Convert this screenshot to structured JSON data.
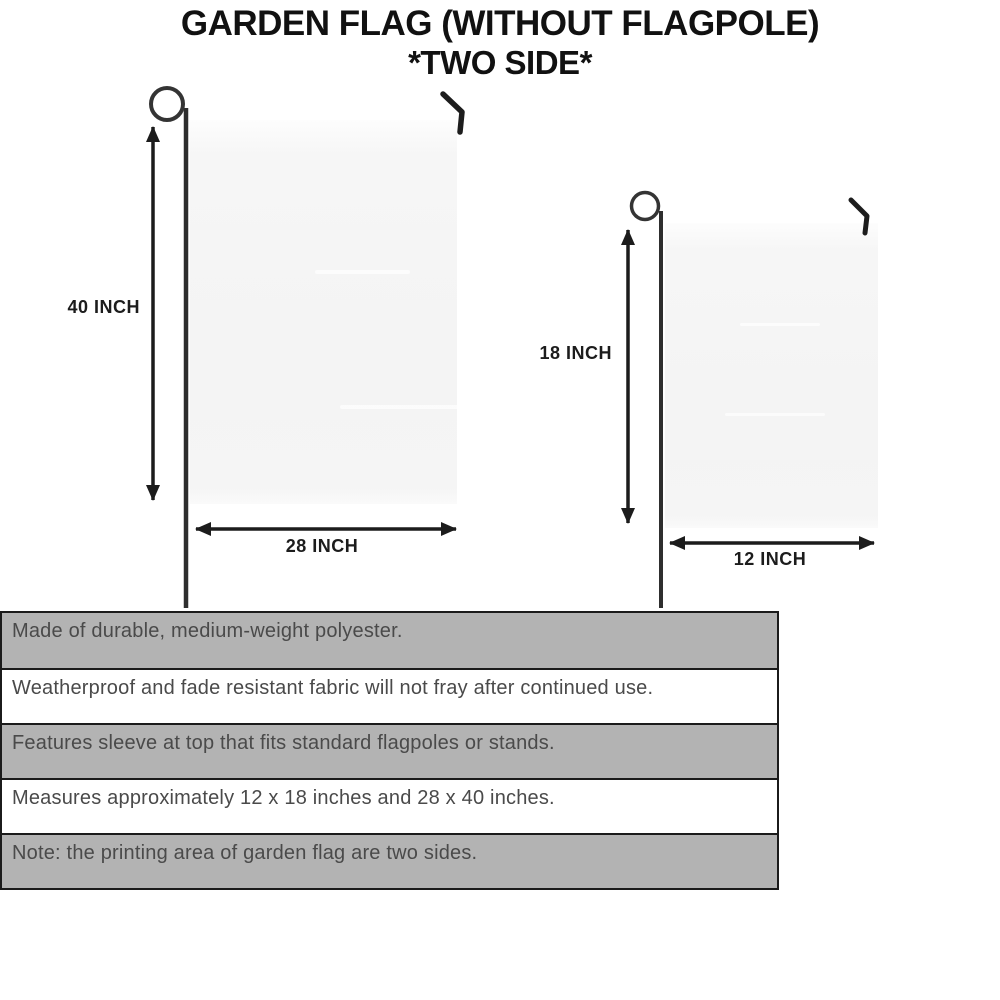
{
  "title": {
    "line1": "GARDEN FLAG (WITHOUT FLAGPOLE)",
    "line2": "*TWO SIDE*"
  },
  "diagram": {
    "large_flag": {
      "height_label": "40 INCH",
      "width_label": "28 INCH"
    },
    "small_flag": {
      "height_label": "18 INCH",
      "width_label": "12 INCH"
    }
  },
  "specs": {
    "rows": [
      {
        "text": "Made of durable, medium-weight polyester.",
        "shaded": true
      },
      {
        "text": "Weatherproof and fade resistant fabric will not fray after continued use.",
        "shaded": false
      },
      {
        "text": "Features sleeve at top that fits standard flagpoles or stands.",
        "shaded": true
      },
      {
        "text": "Measures approximately 12 x 18 inches and 28 x 40 inches.",
        "shaded": false
      },
      {
        "text": "Note: the printing area of garden flag are two sides.",
        "shaded": true
      }
    ]
  },
  "colors": {
    "row_shaded": "#b3b3b3",
    "row_plain": "#ffffff",
    "row_text": "#4a4a4a",
    "flag_fill": "#f5f5f5",
    "pole": "#2e2e2e",
    "arrow": "#1c1c1c",
    "title_text": "#111111"
  }
}
